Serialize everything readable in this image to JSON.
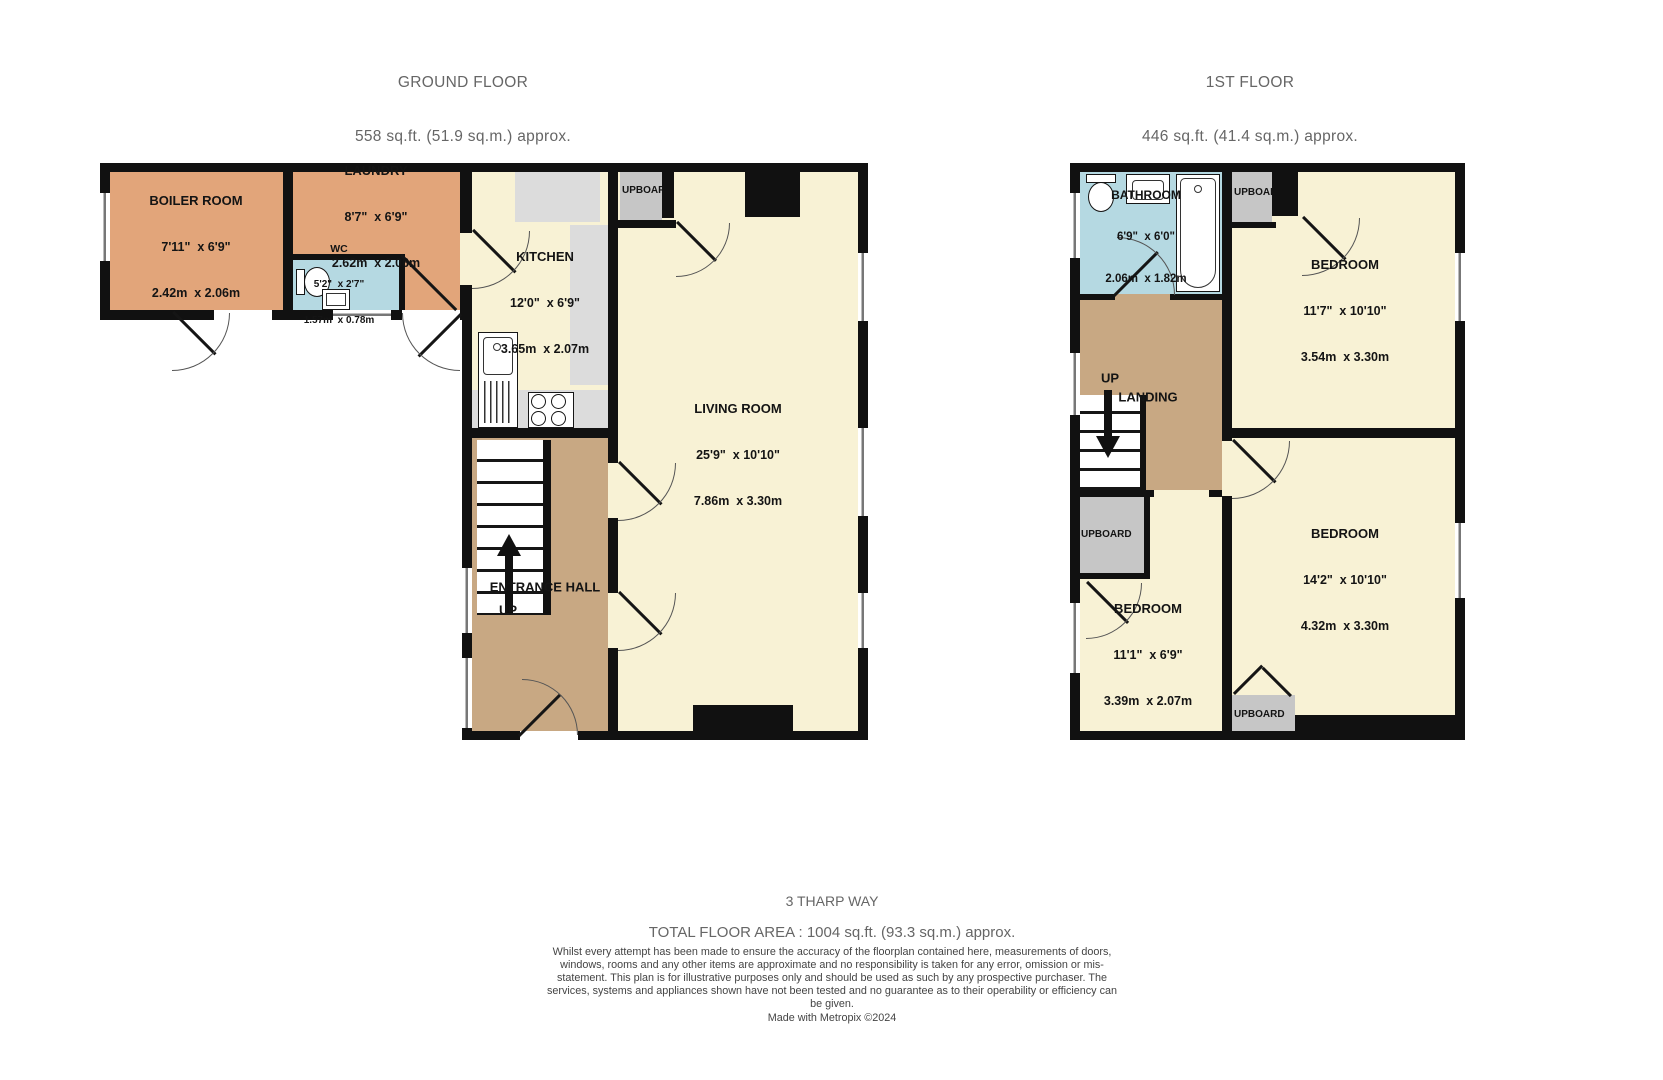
{
  "titles": {
    "ground": {
      "line1": "GROUND FLOOR",
      "line2": "558 sq.ft. (51.9 sq.m.) approx."
    },
    "first": {
      "line1": "1ST FLOOR",
      "line2": "446 sq.ft. (41.4 sq.m.) approx."
    }
  },
  "colors": {
    "utility_orange": "#e2a57a",
    "room_yellow": "#f8f2d5",
    "hall_tan": "#c8a883",
    "wet_blue": "#b5d9e2",
    "cupboard_gray": "#c6c6c6",
    "counter_gray": "#dcdcdc",
    "wall_black": "#111111"
  },
  "ground_floor": {
    "rooms": {
      "boiler_room": {
        "name": "BOILER ROOM",
        "imperial": "7'11\"  x 6'9\"",
        "metric": "2.42m  x 2.06m"
      },
      "laundry": {
        "name": "LAUNDRY",
        "imperial": "8'7\"  x 6'9\"",
        "metric": "2.62m  x 2.06m"
      },
      "wc": {
        "name": "WC",
        "imperial": "5'2\"  x 2'7\"",
        "metric": "1.57m  x 0.78m"
      },
      "kitchen": {
        "name": "KITCHEN",
        "imperial": "12'0\"  x 6'9\"",
        "metric": "3.65m  x 2.07m"
      },
      "living_room": {
        "name": "LIVING ROOM",
        "imperial": "25'9\"  x 10'10\"",
        "metric": "7.86m  x 3.30m"
      },
      "entrance_hall": {
        "name": "ENTRANCE HALL"
      }
    },
    "labels": {
      "up": "UP",
      "cupboard": "UPBOARD"
    }
  },
  "first_floor": {
    "rooms": {
      "bathroom": {
        "name": "BATHROOM",
        "imperial": "6'9\"  x 6'0\"",
        "metric": "2.06m  x 1.82m"
      },
      "bedroom_top": {
        "name": "BEDROOM",
        "imperial": "11'7\"  x 10'10\"",
        "metric": "3.54m  x 3.30m"
      },
      "bedroom_right": {
        "name": "BEDROOM",
        "imperial": "14'2\"  x 10'10\"",
        "metric": "4.32m  x 3.30m"
      },
      "bedroom_left": {
        "name": "BEDROOM",
        "imperial": "11'1\"  x 6'9\"",
        "metric": "3.39m  x 2.07m"
      },
      "landing": {
        "name": "LANDING"
      }
    },
    "labels": {
      "up": "UP",
      "cupboard_top": "UPBOARD",
      "cupboard_left": "UPBOARD",
      "cupboard_bottom": "UPBOARD"
    }
  },
  "footer": {
    "address": "3 THARP WAY",
    "total_area": "TOTAL FLOOR AREA : 1004 sq.ft. (93.3 sq.m.) approx.",
    "disclaimer": "Whilst every attempt has been made to ensure the accuracy of the floorplan contained here, measurements of doors, windows, rooms and any other items are approximate and no responsibility is taken for any error, omission or mis-statement. This plan is for illustrative purposes only and should be used as such by any prospective purchaser. The services, systems and appliances shown have not been tested and no guarantee as to their operability or efficiency can be given.",
    "credit": "Made with Metropix ©2024"
  }
}
